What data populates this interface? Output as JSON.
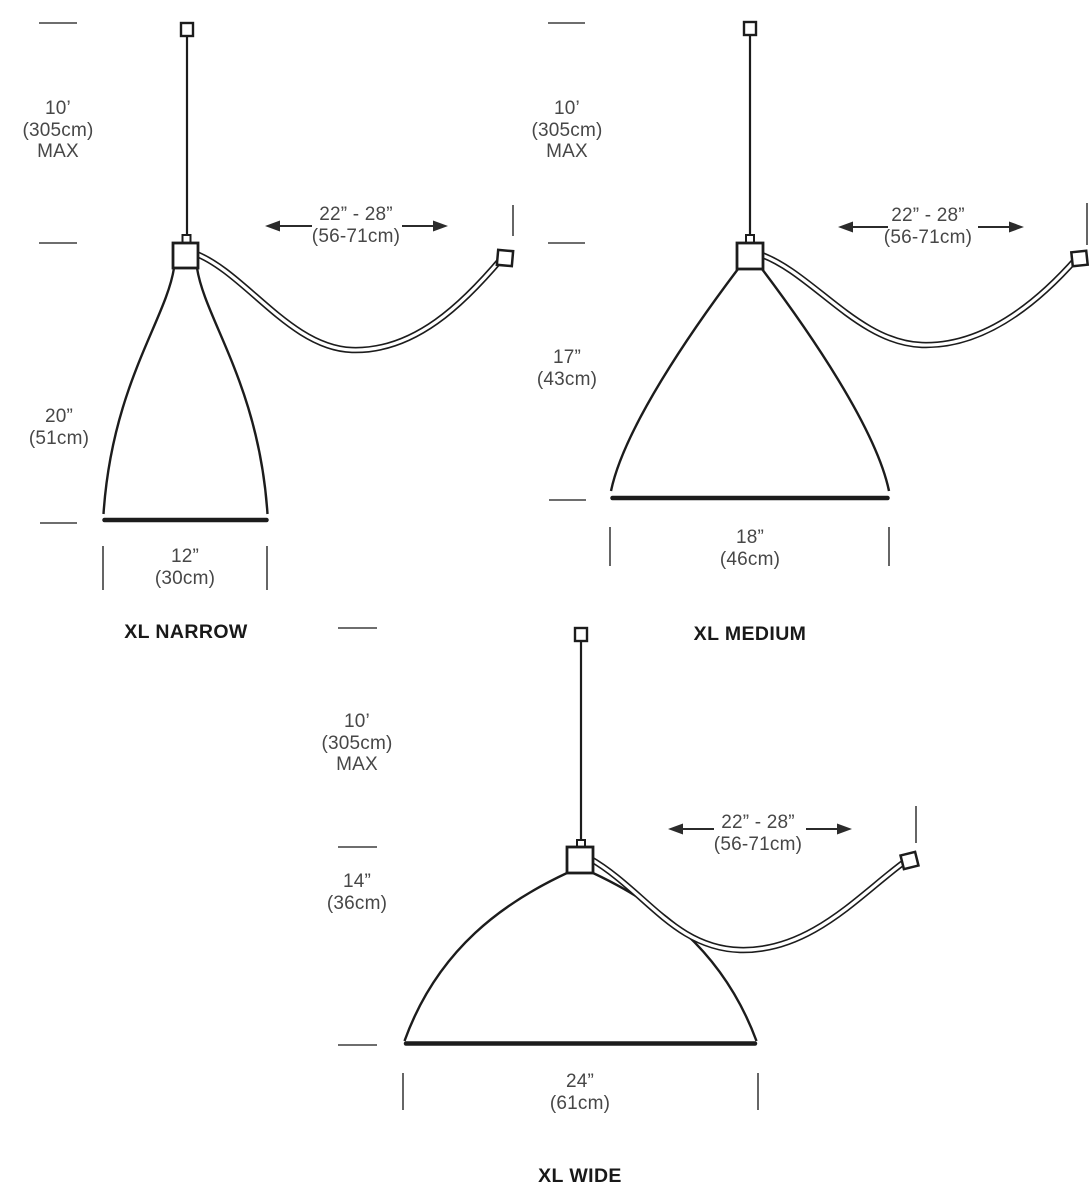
{
  "diagram": {
    "background": "#ffffff",
    "ink_color": "#1c1c1c",
    "dim_text_color": "#474747",
    "label_color": "#191919"
  },
  "lamps": [
    {
      "name": "XL NARROW",
      "max_drop": {
        "l1": "10’",
        "l2": "(305cm)",
        "l3": "MAX"
      },
      "shade_height": {
        "l1": "20”",
        "l2": "(51cm)"
      },
      "shade_width": {
        "l1": "12”",
        "l2": "(30cm)"
      },
      "swag_span": {
        "l1": "22” - 28”",
        "l2": "(56-71cm)"
      }
    },
    {
      "name": "XL MEDIUM",
      "max_drop": {
        "l1": "10’",
        "l2": "(305cm)",
        "l3": "MAX"
      },
      "shade_height": {
        "l1": "17”",
        "l2": "(43cm)"
      },
      "shade_width": {
        "l1": "18”",
        "l2": "(46cm)"
      },
      "swag_span": {
        "l1": "22” - 28”",
        "l2": "(56-71cm)"
      }
    },
    {
      "name": "XL WIDE",
      "max_drop": {
        "l1": "10’",
        "l2": "(305cm)",
        "l3": "MAX"
      },
      "shade_height": {
        "l1": "14”",
        "l2": "(36cm)"
      },
      "shade_width": {
        "l1": "24”",
        "l2": "(61cm)"
      },
      "swag_span": {
        "l1": "22” - 28”",
        "l2": "(56-71cm)"
      }
    }
  ]
}
